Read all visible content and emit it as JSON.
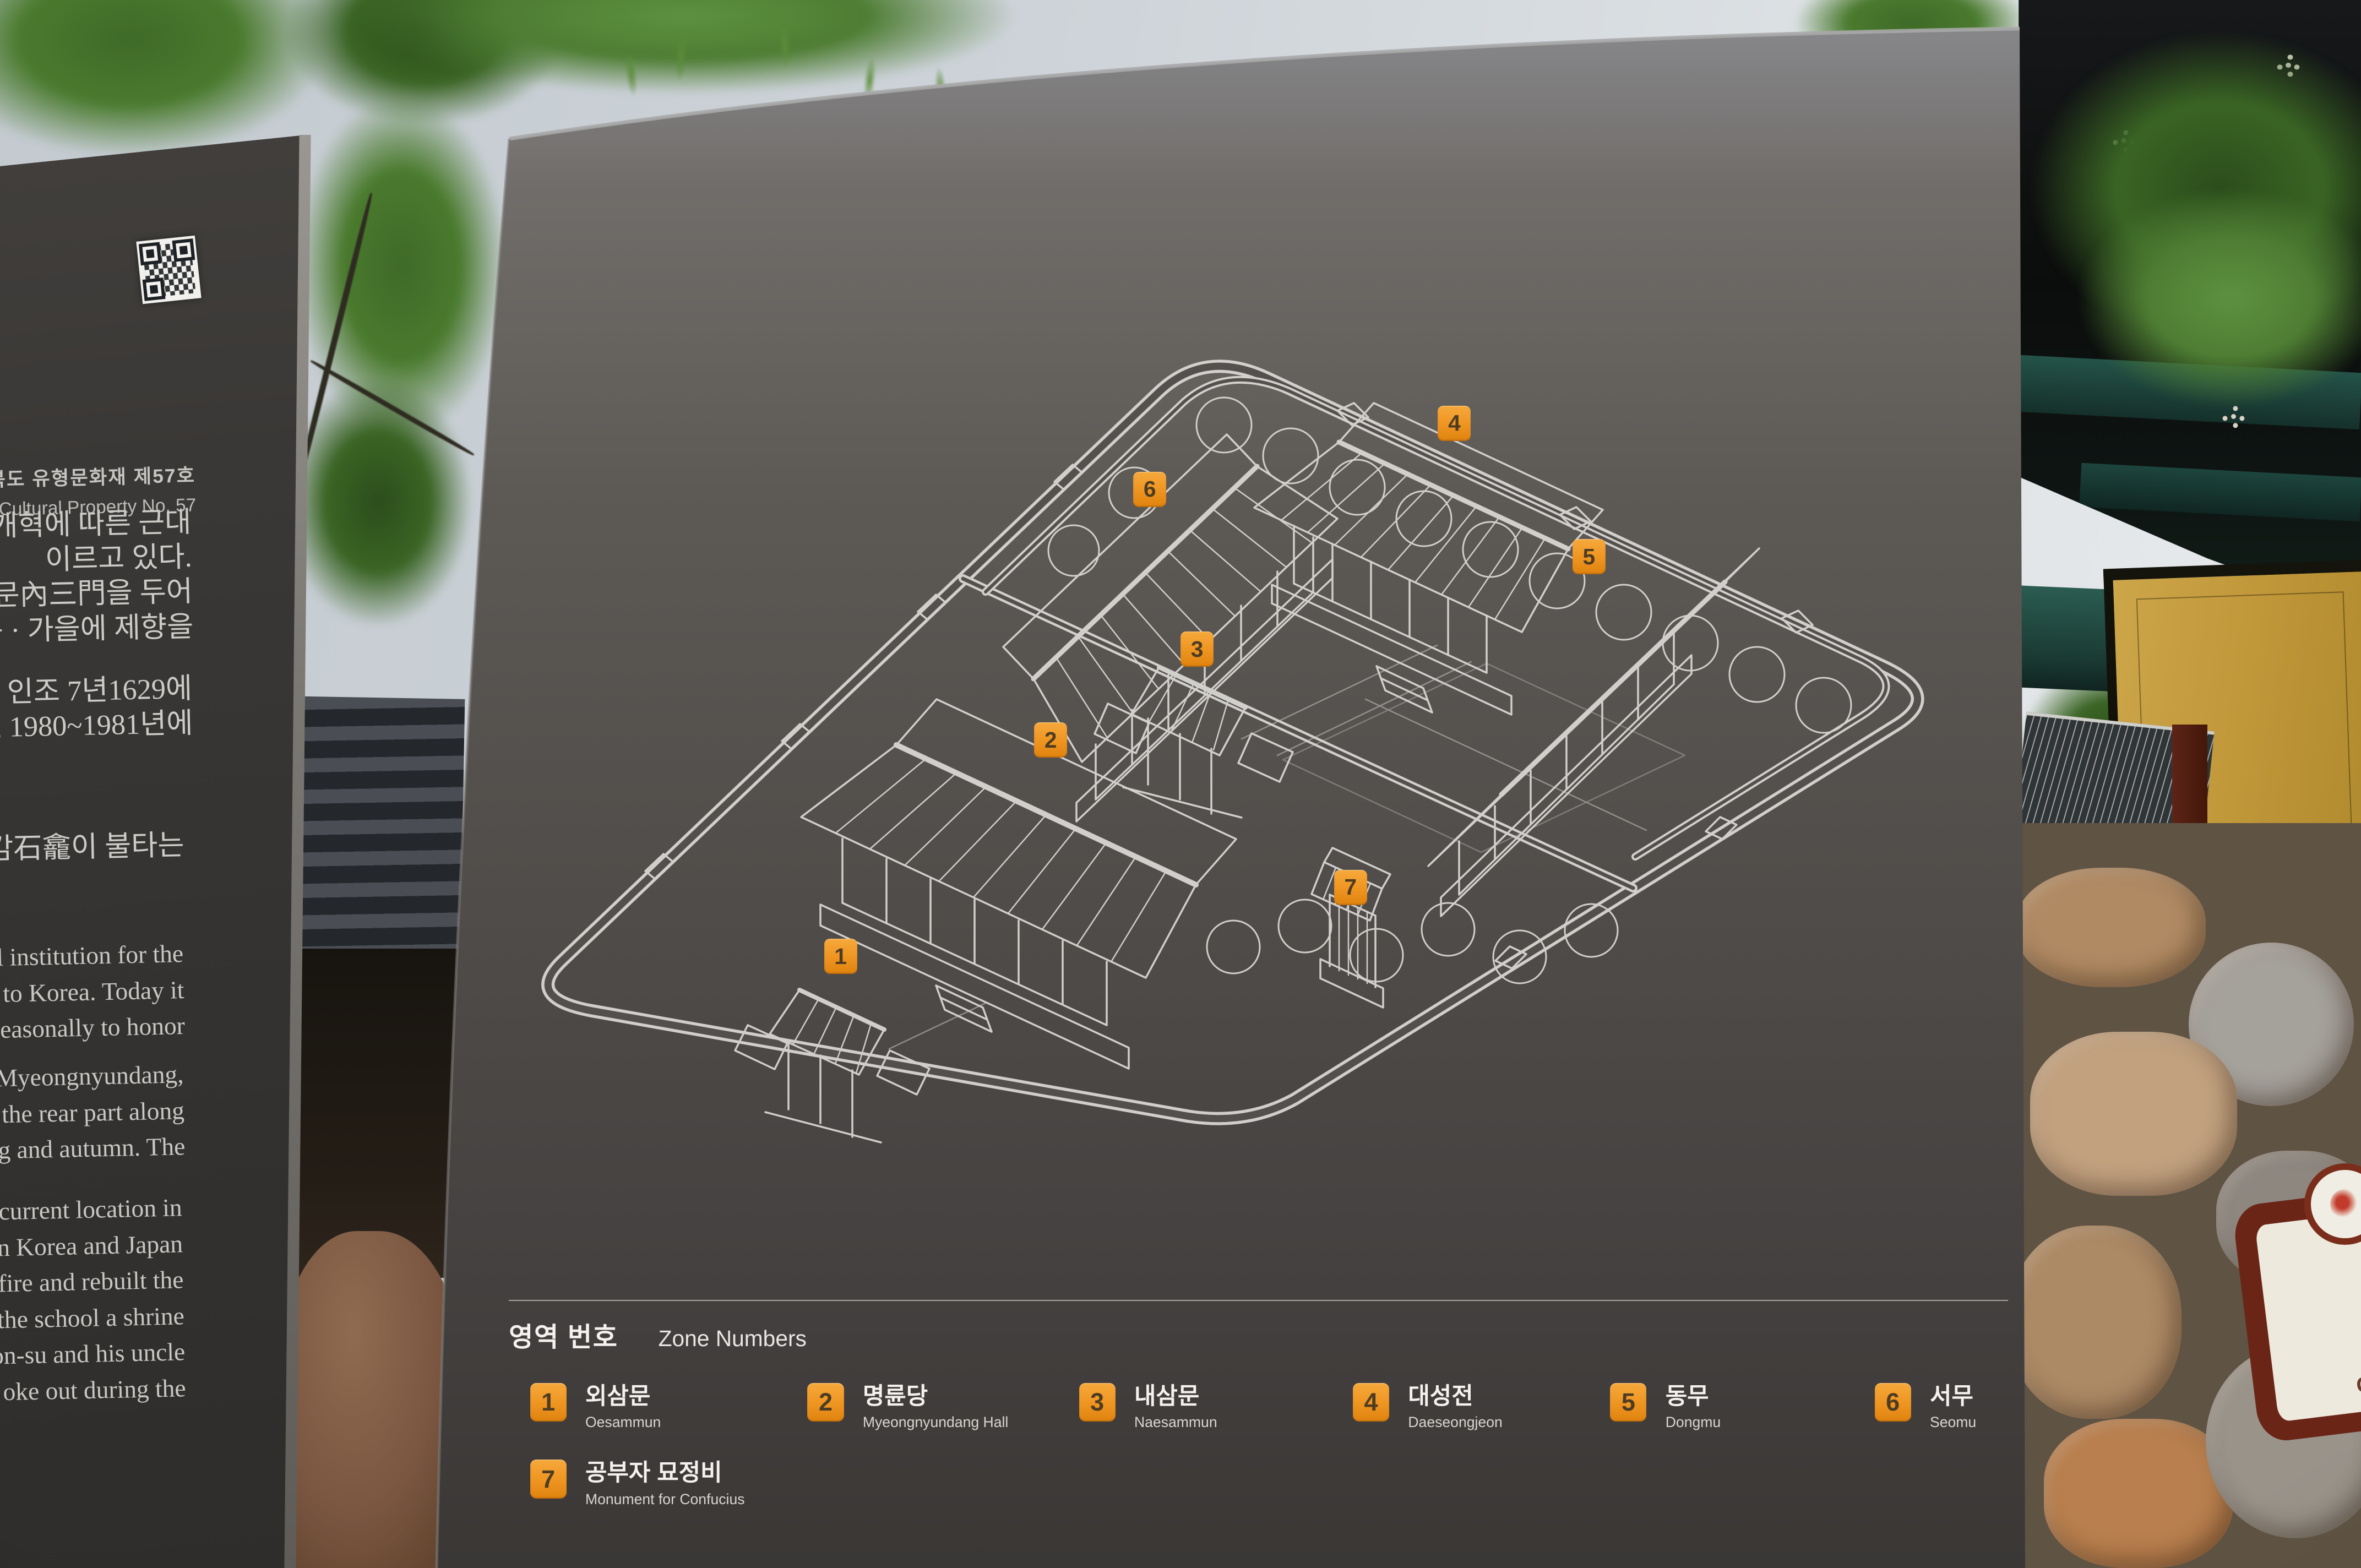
{
  "photo": {
    "colors": {
      "sky": "#cdd3d8",
      "board_top": "#87878a",
      "board_mid": "#514d4a",
      "board_bottom": "#3a3735",
      "left_sign": "#3a3836",
      "line_art": "#d8d6d2",
      "badge_orange": "#ee9420",
      "badge_text": "#4e3c22",
      "panel_yellow": "#c09739",
      "eaves_teal": "#245349",
      "stone_tan": "#b08a63"
    }
  },
  "left_sign": {
    "registration_ko": "충청북도 유형문화재 제57호",
    "registration_en": "gible Cultural Property No. 57",
    "korean_para_1": [
      "나 갑오개혁에 따른 근대",
      "이르고 있다.",
      "에 내삼문內三門을 두어",
      "고 봄 · 가을에 제향을"
    ],
    "korean_para_2": [
      "불타자, 인조 7년1629에",
      "고, 1980~1981년에"
    ],
    "korean_para_3": [
      "부 석감石龕이 불타는"
    ],
    "english_para_1": [
      "nal institution for the",
      "m to Korea. Today it",
      "seasonally to honor"
    ],
    "english_para_2": [
      ", Myeongnyundang,",
      "n the rear part along",
      "ng and autumn. The"
    ],
    "english_para_3": [
      "current location in",
      "en Korea and Japan",
      "fire and rebuilt the",
      "the school a shrine",
      "on-su and his uncle",
      "oke out during the"
    ]
  },
  "board": {
    "legend_title_ko": "영역 번호",
    "legend_title_en": "Zone Numbers",
    "zones": [
      {
        "num": "1",
        "ko": "외삼문",
        "en": "Oesammun"
      },
      {
        "num": "2",
        "ko": "명륜당",
        "en": "Myeongnyundang Hall"
      },
      {
        "num": "3",
        "ko": "내삼문",
        "en": "Naesammun"
      },
      {
        "num": "4",
        "ko": "대성전",
        "en": "Daeseongjeon"
      },
      {
        "num": "5",
        "ko": "동무",
        "en": "Dongmu"
      },
      {
        "num": "6",
        "ko": "서무",
        "en": "Seomu"
      },
      {
        "num": "7",
        "ko": "공부자 묘정비",
        "en": "Monument for Confucius"
      }
    ]
  },
  "corner_sign": {
    "ko": "교",
    "en": "Gyo"
  }
}
